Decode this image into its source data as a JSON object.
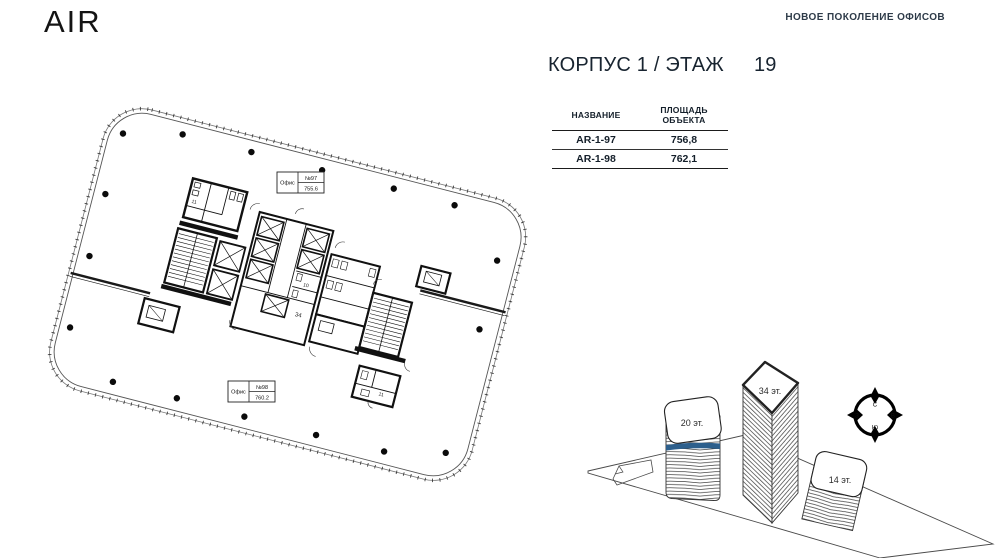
{
  "header": {
    "brand": "AIR",
    "tagline": "НОВОЕ ПОКОЛЕНИЕ ОФИСОВ"
  },
  "title": {
    "prefix": "КОРПУС 1 / ЭТАЖ",
    "floor": "19"
  },
  "table": {
    "col1": "НАЗВАНИЕ",
    "col2_line1": "ПЛОЩАДЬ",
    "col2_line2": "ОБЪЕКТА",
    "rows": [
      {
        "name": "AR-1-97",
        "area": "756,8"
      },
      {
        "name": "AR-1-98",
        "area": "762,1"
      }
    ]
  },
  "plan": {
    "office_top": {
      "label": "Офис",
      "number": "№97",
      "area": "755.6"
    },
    "office_bottom": {
      "label": "Офис",
      "number": "№98",
      "area": "760.2"
    },
    "rooms": {
      "wc_left": "11",
      "wc_mid": "10",
      "hall": "34",
      "wc_right": "11"
    }
  },
  "site": {
    "buildings": [
      {
        "label": "20 эт."
      },
      {
        "label": "34 эт."
      },
      {
        "label": "14 эт."
      }
    ],
    "highlight_color": "#2d5f8c",
    "compass": {
      "north": "С",
      "east": "В",
      "south": "Ю",
      "west": "З"
    }
  }
}
